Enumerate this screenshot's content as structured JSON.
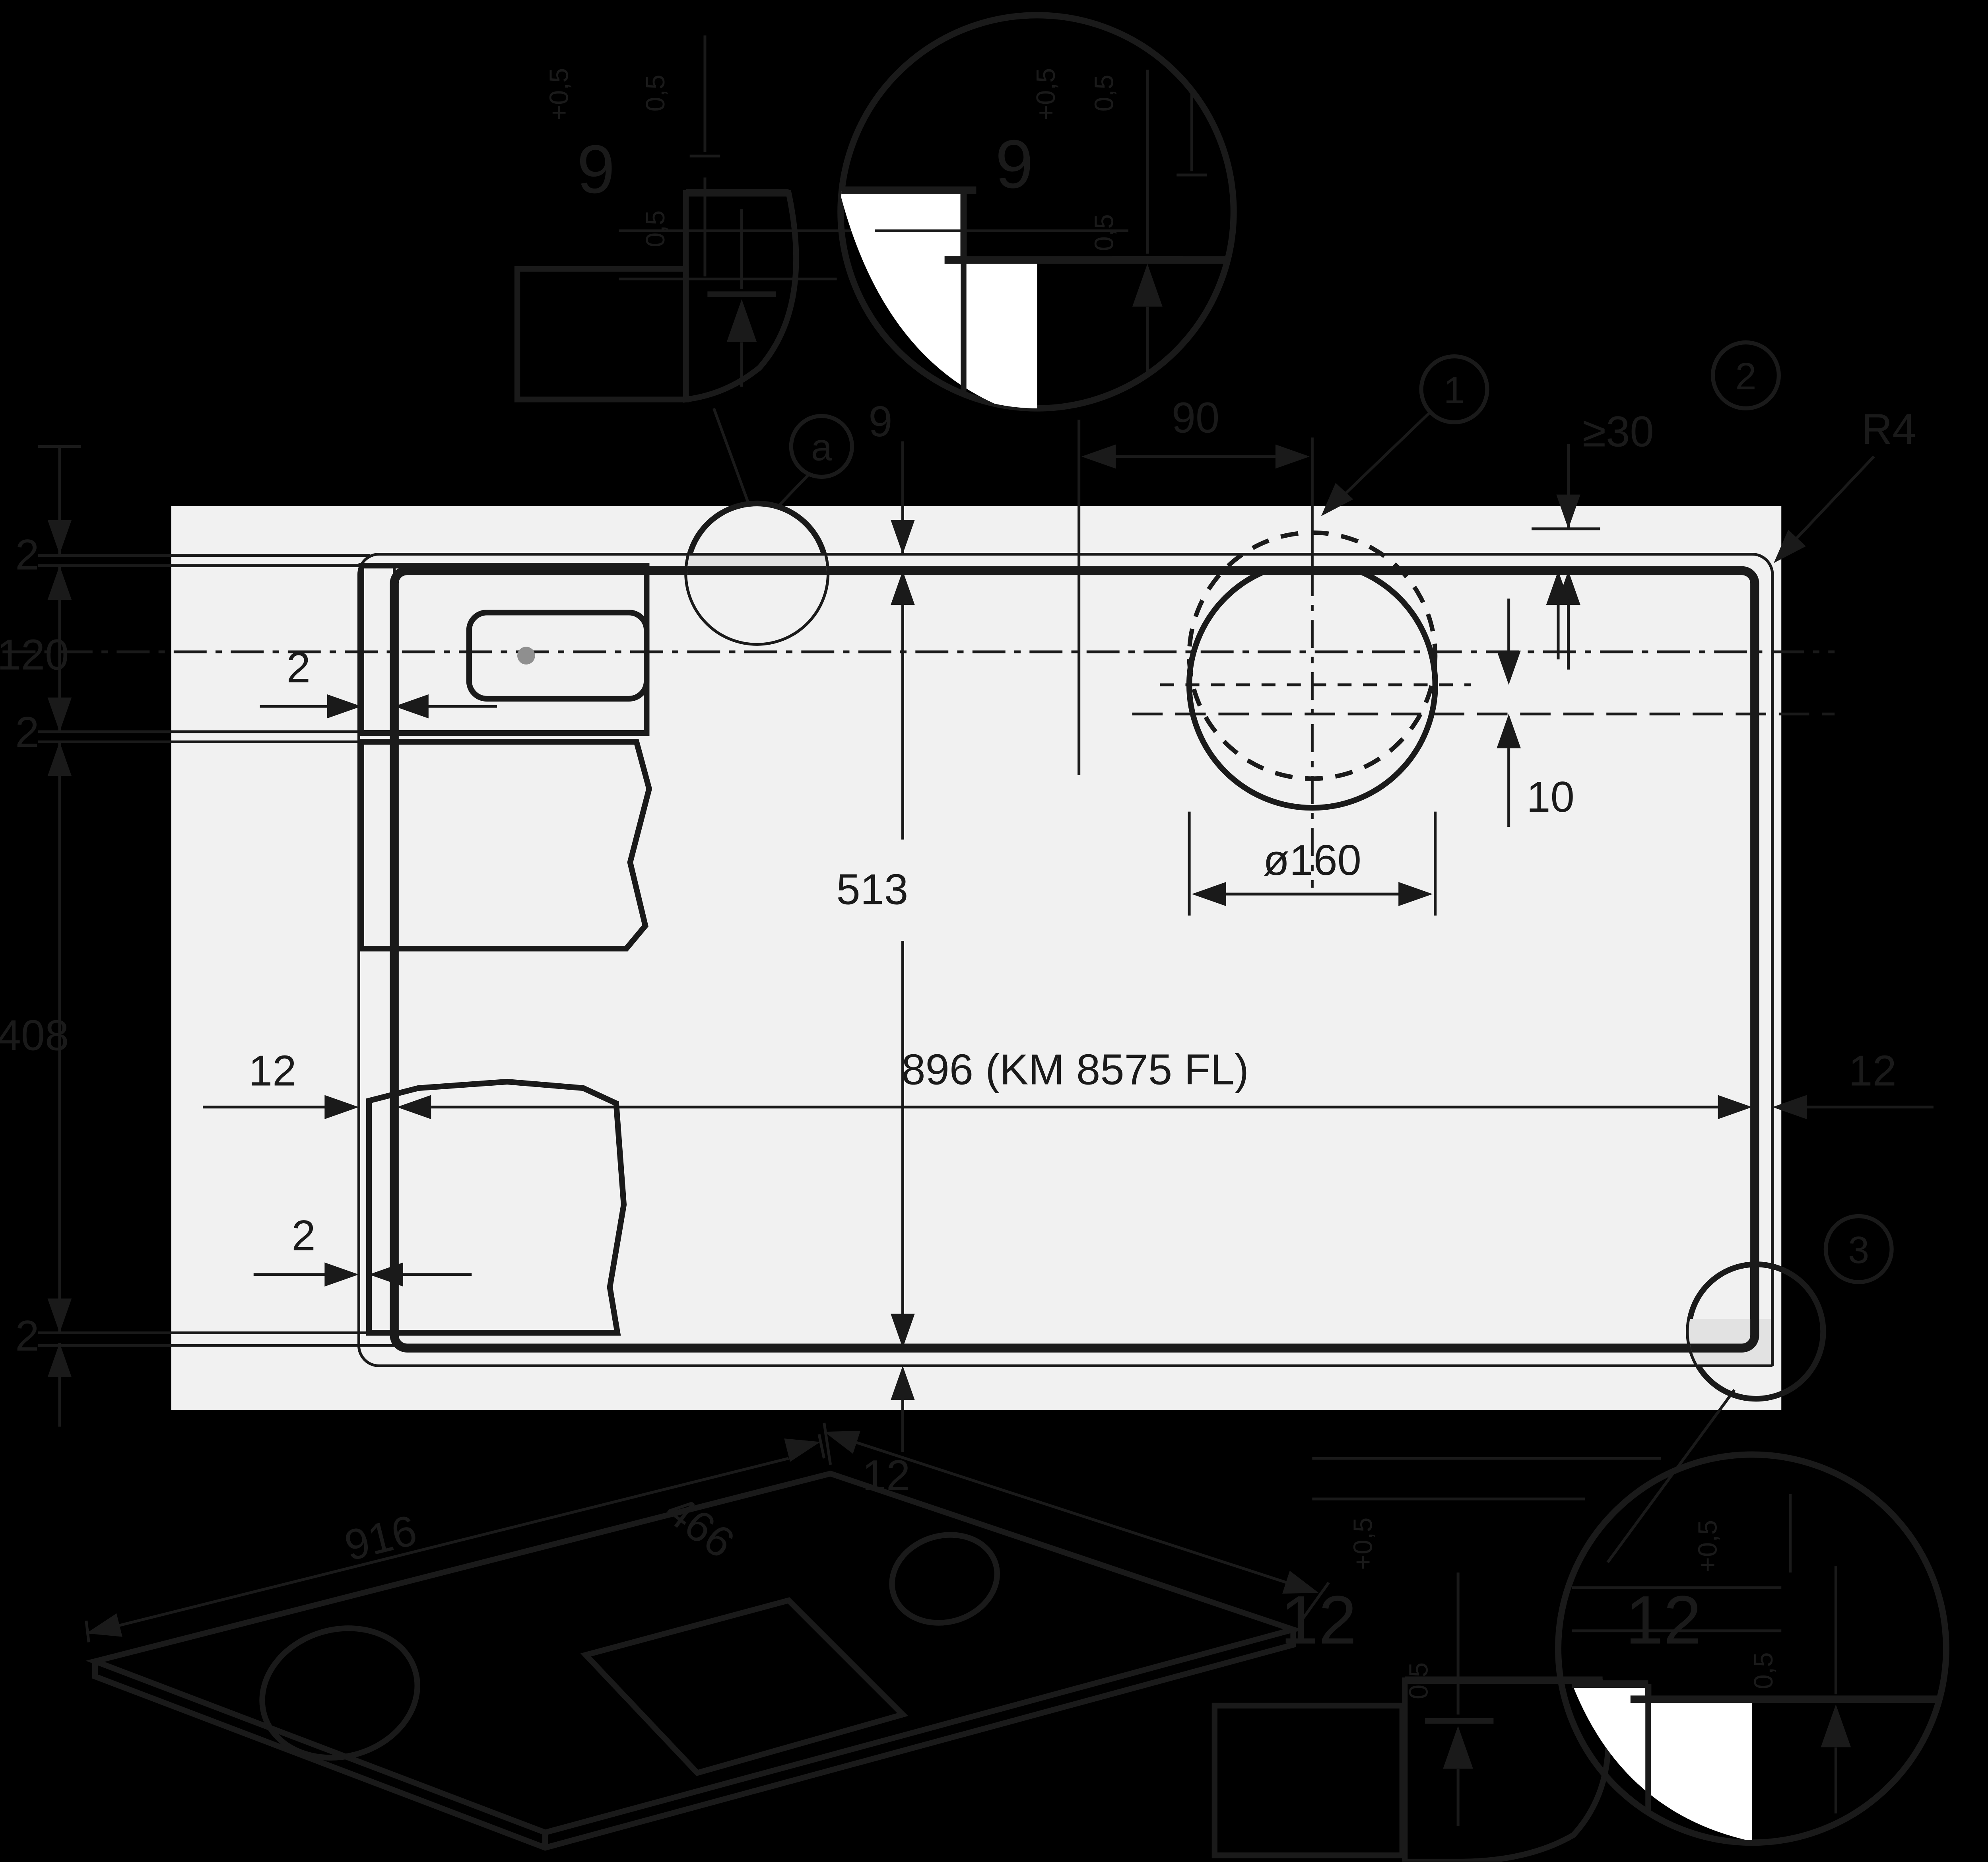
{
  "drawing": {
    "title": "Cooktop flush-mount installation dimensions",
    "model_note": "896 (KM 8575 FL)",
    "dims": {
      "ledge_top": "9",
      "knob_offset_x": "90",
      "min_clearance": "≥30",
      "corner_radius": "R4",
      "cutout_depth": "513",
      "knob_hole_dia": "ø160",
      "center_offset": "10",
      "cutout_width_label": "896 (KM 8575 FL)",
      "ledge_12": "12",
      "gap_2": "2",
      "front_120": "120",
      "body_408": "408",
      "iso_width": "916",
      "iso_depth": "466",
      "detail_depth_9": "9",
      "detail_depth_12": "12",
      "tol_plus": "+0,5",
      "tol_half": "0,5"
    },
    "callouts": {
      "c1": "1",
      "c2": "2",
      "c3": "3",
      "ca": "a"
    },
    "colors": {
      "background": "#000000",
      "line": "#1a1a1a",
      "worktop": "#f1f1f1",
      "recess_band": "#e2e2e2",
      "appliance_gray": "#d4d4d4",
      "detail_gray": "#d7d7d7",
      "iso_slab": "#d9d9d9",
      "white_fill": "#ffffff"
    }
  }
}
